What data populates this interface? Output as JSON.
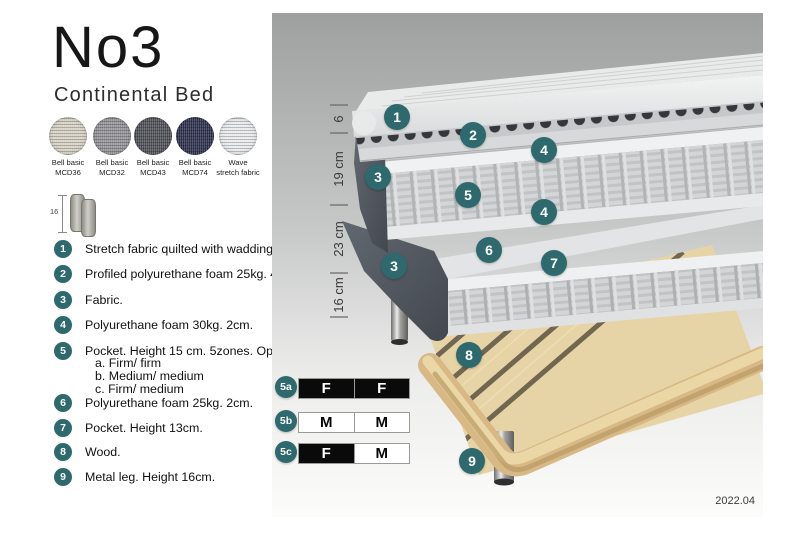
{
  "header": {
    "title": "No3",
    "subtitle": "Continental Bed"
  },
  "swatches": [
    {
      "line1": "Bell basic",
      "line2": "MCD36",
      "color": "#D8D3C6"
    },
    {
      "line1": "Bell basic",
      "line2": "MCD32",
      "color": "#96969A"
    },
    {
      "line1": "Bell basic",
      "line2": "MCD43",
      "color": "#53545A"
    },
    {
      "line1": "Bell basic",
      "line2": "MCD74",
      "color": "#303450"
    },
    {
      "line1": "Wave",
      "line2": "stretch fabric",
      "color": "#E9EBED"
    }
  ],
  "leg_icon": {
    "height_label": "16"
  },
  "legend": {
    "items": [
      {
        "num": "1",
        "text": "Stretch fabric quilted with wadding."
      },
      {
        "num": "2",
        "text": "Profiled polyurethane foam 25kg. 4cm."
      },
      {
        "num": "3",
        "text": "Fabric."
      },
      {
        "num": "4",
        "text": "Polyurethane foam 30kg. 2cm."
      },
      {
        "num": "5",
        "text": "Pocket. Height 15 cm. 5zones. Option:",
        "options": [
          "a. Firm/ firm",
          "b. Medium/ medium",
          "c. Firm/ medium"
        ]
      },
      {
        "num": "6",
        "text": "Polyurethane foam 25kg. 2cm."
      },
      {
        "num": "7",
        "text": "Pocket. Height 13cm."
      },
      {
        "num": "8",
        "text": "Wood."
      },
      {
        "num": "9",
        "text": "Metal leg. Height 16cm."
      }
    ]
  },
  "diagram": {
    "dimension_labels": [
      "6",
      "19 cm",
      "23 cm",
      "16 cm"
    ],
    "badges": [
      "1",
      "2",
      "3",
      "4",
      "5",
      "4",
      "6",
      "7",
      "3",
      "8",
      "9"
    ],
    "firmness_table": [
      {
        "label": "5a",
        "cells": [
          {
            "text": "F",
            "variant": "dark"
          },
          {
            "text": "F",
            "variant": "dark"
          }
        ]
      },
      {
        "label": "5b",
        "cells": [
          {
            "text": "M",
            "variant": "light"
          },
          {
            "text": "M",
            "variant": "light"
          }
        ]
      },
      {
        "label": "5c",
        "cells": [
          {
            "text": "F",
            "variant": "dark"
          },
          {
            "text": "M",
            "variant": "light"
          }
        ]
      }
    ],
    "version": "2022.04"
  },
  "colors": {
    "badge_teal": "#2E6A6D",
    "table_dark_cell": "#0A0A0A",
    "fabric_dark_gray": "#545A61",
    "wood": "#E7D4A6",
    "mattress_light": "#E4E6E7"
  }
}
